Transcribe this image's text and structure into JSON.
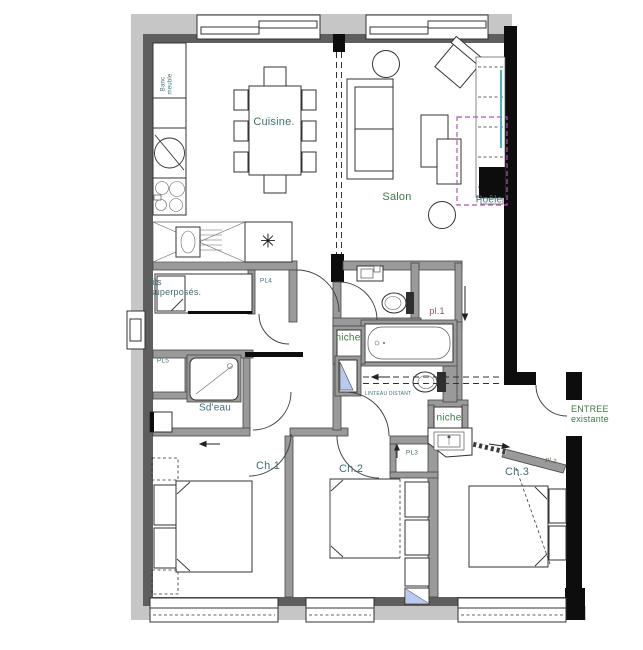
{
  "plan": {
    "type": "architectural-floor-plan",
    "rooms": [
      "Cuisine.",
      "Salon",
      "Sd'eau",
      "Ch.1",
      "Ch.2",
      "Ch.3",
      "ENTREE existante"
    ],
    "closets": [
      "pl.1",
      "pl.2",
      "PL3",
      "PL4",
      "PL5"
    ],
    "features": [
      "Poêle",
      "niche",
      "niche",
      "lits superposés.",
      "Banc meuble",
      "LINTEAU DISTANT"
    ]
  },
  "colors": {
    "teal": "#3f7076",
    "green": "#3e7a44",
    "maroon": "#8a5560",
    "brown": "#6e6158",
    "ink": "#1a1a1a",
    "wall_gray": "#9a9a9a",
    "outer_band": "#c6c6c6",
    "inner_band": "#5e5e5e",
    "black_wall": "#0d0d0d",
    "magenta": "#b455b4",
    "cyan": "#45b6ba",
    "shower_blue": "#b9c9ef"
  },
  "labels": [
    {
      "id": "cuisine",
      "text": "Cuisine.",
      "x": 274,
      "y": 122,
      "size": 11,
      "color": "teal"
    },
    {
      "id": "salon",
      "text": "Salon",
      "x": 397,
      "y": 197,
      "size": 11,
      "color": "green"
    },
    {
      "id": "poele",
      "text": "Poêle",
      "x": 489,
      "y": 200,
      "size": 10,
      "color": "teal"
    },
    {
      "id": "banc-meuble",
      "text": "Banc\nmeuble",
      "x": 167,
      "y": 84,
      "size": 6,
      "color": "teal",
      "rotate": -90
    },
    {
      "id": "lits-superposes",
      "text": "lits\nsuperposés.",
      "x": 150,
      "y": 287,
      "size": 9,
      "color": "teal",
      "anchor": "left"
    },
    {
      "id": "pl4",
      "text": "PL4",
      "x": 266,
      "y": 281,
      "size": 6.5,
      "color": "teal"
    },
    {
      "id": "pl5",
      "text": "PL5",
      "x": 163,
      "y": 361,
      "size": 6.5,
      "color": "teal"
    },
    {
      "id": "sdeau",
      "text": "Sd'eau",
      "x": 215,
      "y": 408,
      "size": 10,
      "color": "teal"
    },
    {
      "id": "pl1",
      "text": "pl.1",
      "x": 437,
      "y": 311,
      "size": 9,
      "color": "maroon"
    },
    {
      "id": "niche-1",
      "text": "niche",
      "x": 348,
      "y": 338,
      "size": 10,
      "color": "green"
    },
    {
      "id": "niche-2",
      "text": "niche",
      "x": 449,
      "y": 418,
      "size": 10,
      "color": "green"
    },
    {
      "id": "linteau-distant",
      "text": "LINTEAU DISTANT",
      "x": 388,
      "y": 395,
      "size": 5,
      "color": "teal"
    },
    {
      "id": "entree-existante",
      "text": "ENTREE\nexistante",
      "x": 571,
      "y": 414,
      "size": 9,
      "color": "green",
      "anchor": "left"
    },
    {
      "id": "ch1",
      "text": "Ch.1",
      "x": 268,
      "y": 466,
      "size": 11,
      "color": "teal"
    },
    {
      "id": "ch2",
      "text": "Ch.2",
      "x": 351,
      "y": 469,
      "size": 11,
      "color": "teal"
    },
    {
      "id": "ch3",
      "text": "Ch.3",
      "x": 517,
      "y": 472,
      "size": 11,
      "color": "teal"
    },
    {
      "id": "pl3",
      "text": "PL3",
      "x": 412,
      "y": 453,
      "size": 6.5,
      "color": "teal"
    },
    {
      "id": "pl2",
      "text": "pl.2",
      "x": 551,
      "y": 461,
      "size": 6.5,
      "color": "brown",
      "rotate": 14
    },
    {
      "id": "water-heater-symbol",
      "text": "✳",
      "x": 268,
      "y": 242,
      "size": 19,
      "color": "ink"
    }
  ]
}
